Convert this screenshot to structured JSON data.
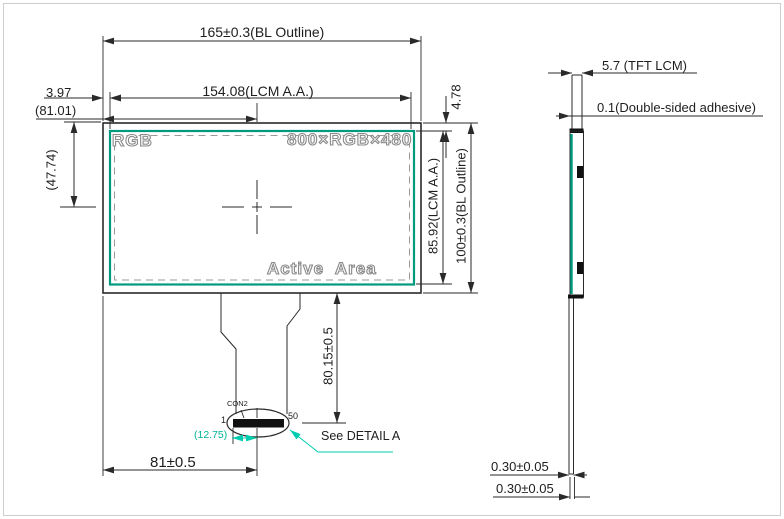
{
  "drawing": {
    "front": {
      "dim_bl_width": "165±0.3(BL Outline)",
      "dim_aa_width": "154.08(LCM A.A.)",
      "dim_left_border": "3.97",
      "dim_center_x": "(81.01)",
      "dim_center_y": "(47.74)",
      "dim_top_border": "4.78",
      "dim_aa_height": "85.92(LCM A.A.)",
      "dim_bl_height": "100±0.3(BL Outline)",
      "label_rgb": "RGB",
      "label_resolution": "800×RGB×480",
      "label_active_area": "Active  Area",
      "dim_fpc_length": "80.15±0.5",
      "dim_connector_x": "81±0.5"
    },
    "connector": {
      "name": "CON2",
      "pin_first": "1",
      "pin_last": "50",
      "dim_pin_offset": "(12.75)",
      "detail_note": "See DETAIL A"
    },
    "side": {
      "dim_thickness": "5.7 (TFT LCM)",
      "dim_adhesive": "0.1(Double-sided adhesive)",
      "dim_tape_upper": "0.30±0.05",
      "dim_tape_lower": "0.30±0.05"
    },
    "colors": {
      "accent_teal": "#009a7d",
      "annotation_teal": "#00cdb0",
      "line_black": "#2a2a2a",
      "outline_text_gray": "#8a8a8a"
    }
  }
}
